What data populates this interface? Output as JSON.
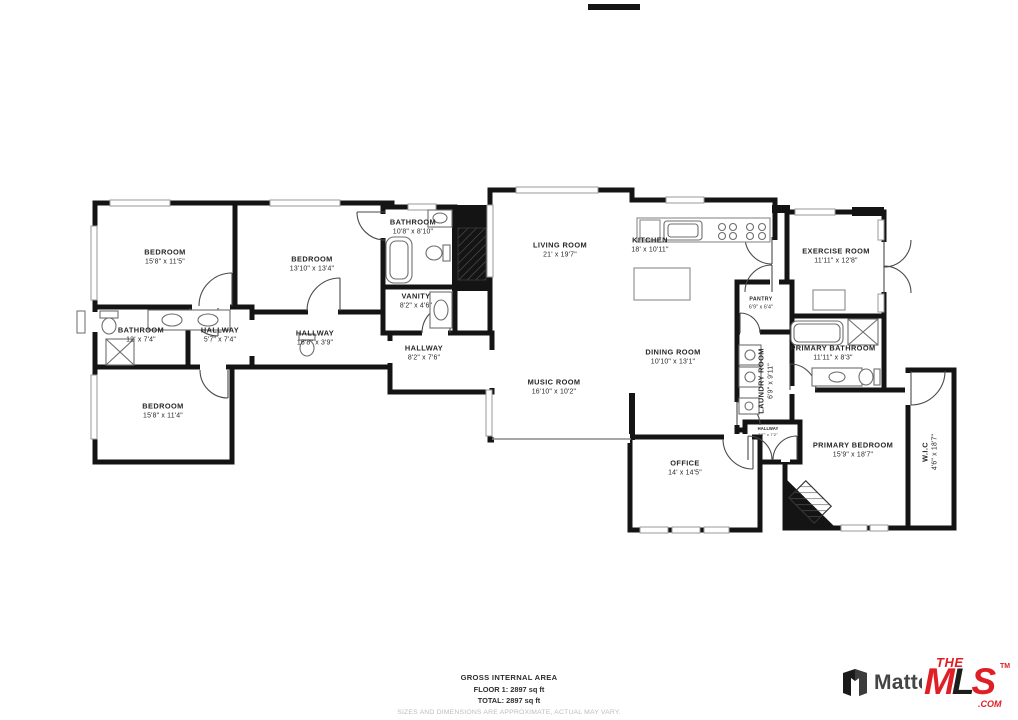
{
  "rooms": [
    {
      "name": "BEDROOM",
      "dims": "15'8\" x 11'5\""
    },
    {
      "name": "BEDROOM",
      "dims": "13'10\" x 13'4\""
    },
    {
      "name": "BATHROOM",
      "dims": "12' x 7'4\""
    },
    {
      "name": "HALLWAY",
      "dims": "5'7\" x 7'4\""
    },
    {
      "name": "HALLWAY",
      "dims": "16'8\" x 3'9\""
    },
    {
      "name": "BEDROOM",
      "dims": "15'8\" x 11'4\""
    },
    {
      "name": "BATHROOM",
      "dims": "10'8\" x 8'10\""
    },
    {
      "name": "VANITY",
      "dims": "8'2\" x 4'6\""
    },
    {
      "name": "HALLWAY",
      "dims": "8'2\" x 7'6\""
    },
    {
      "name": "LIVING ROOM",
      "dims": "21' x 19'7\""
    },
    {
      "name": "MUSIC ROOM",
      "dims": "16'10\" x 10'2\""
    },
    {
      "name": "KITCHEN",
      "dims": "18' x 10'11\""
    },
    {
      "name": "PANTRY",
      "dims": "6'9\" x 6'4\""
    },
    {
      "name": "DINING ROOM",
      "dims": "10'10\" x 13'1\""
    },
    {
      "name": "LAUNDRY ROOM",
      "dims": "6'9\" x 9'11\""
    },
    {
      "name": "HALLWAY",
      "dims": "7'7\" x 7'2\""
    },
    {
      "name": "EXERCISE ROOM",
      "dims": "11'11\" x 12'8\""
    },
    {
      "name": "PRIMARY BATHROOM",
      "dims": "11'11\" x 8'3\""
    },
    {
      "name": "PRIMARY BEDROOM",
      "dims": "15'9\" x 18'7\""
    },
    {
      "name": "W.I.C",
      "dims": "4'6\" x 18'7\""
    },
    {
      "name": "OFFICE",
      "dims": "14' x 14'5\""
    }
  ],
  "footer": {
    "title": "GROSS INTERNAL AREA",
    "floor": "FLOOR 1: 2897 sq ft",
    "total": "TOTAL: 2897 sq ft",
    "disclaimer": "SIZES AND DIMENSIONS ARE APPROXIMATE, ACTUAL MAY VARY."
  },
  "branding": {
    "matterport": "Matterport",
    "mls_the": "THE",
    "mls_m": "M",
    "mls_l": "L",
    "mls_s": "S",
    "mls_tm": "TM",
    "mls_com": ".COM",
    "mls_red": "#e01e26",
    "wall_color": "#141414"
  }
}
